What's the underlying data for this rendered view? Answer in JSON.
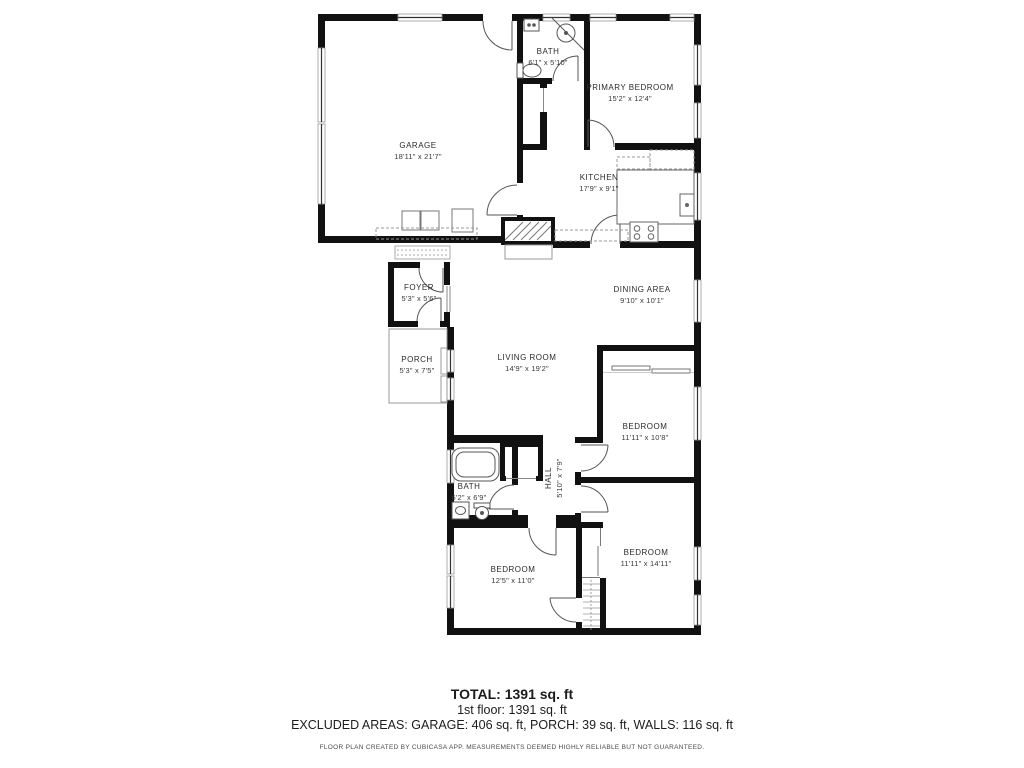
{
  "floor_plan": {
    "rooms": [
      {
        "name": "GARAGE",
        "dims": "18'11\" x 21'7\""
      },
      {
        "name": "BATH",
        "dims": "6'1\" x 5'10\""
      },
      {
        "name": "PRIMARY BEDROOM",
        "dims": "15'2\" x 12'4\""
      },
      {
        "name": "KITCHEN",
        "dims": "17'9\" x 9'1\""
      },
      {
        "name": "FOYER",
        "dims": "5'3\" x 5'6\""
      },
      {
        "name": "DINING AREA",
        "dims": "9'10\" x 10'1\""
      },
      {
        "name": "PORCH",
        "dims": "5'3\" x 7'5\""
      },
      {
        "name": "LIVING ROOM",
        "dims": "14'9\" x 19'2\""
      },
      {
        "name": "BEDROOM",
        "dims": "11'11\" x 10'8\""
      },
      {
        "name": "BATH",
        "dims": "6'2\" x 6'9\""
      },
      {
        "name": "HALL",
        "dims": "5'10\" x 7'9\""
      },
      {
        "name": "BEDROOM",
        "dims": "12'5\" x 11'0\""
      },
      {
        "name": "BEDROOM",
        "dims": "11'11\" x 14'11\""
      }
    ],
    "footer": {
      "total": "TOTAL: 1391 sq. ft",
      "floor": "1st floor: 1391 sq. ft",
      "excluded": "EXCLUDED AREAS: GARAGE: 406 sq. ft, PORCH: 39 sq. ft, WALLS: 116 sq. ft",
      "disclaimer": "FLOOR PLAN CREATED BY CUBICASA APP. MEASUREMENTS DEEMED HIGHLY RELIABLE BUT NOT GUARANTEED."
    },
    "colors": {
      "walls": "#111111",
      "thin_lines": "#666666"
    }
  }
}
